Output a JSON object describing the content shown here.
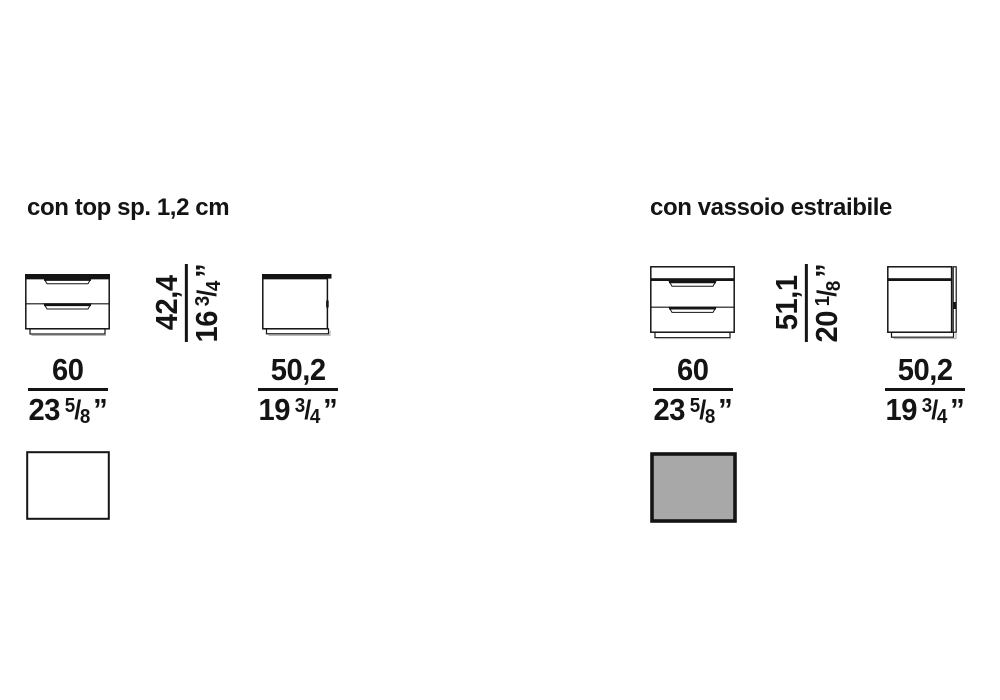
{
  "inch_mark": "”",
  "fraction_slash": "/",
  "sections": [
    {
      "title": "con top sp. 1,2 cm",
      "height": {
        "cm": "42,4",
        "in_whole": "16",
        "in_num": "3",
        "in_den": "4"
      },
      "width": {
        "cm": "60",
        "in_whole": "23",
        "in_num": "5",
        "in_den": "8"
      },
      "depth": {
        "cm": "50,2",
        "in_whole": "19",
        "in_num": "3",
        "in_den": "4"
      },
      "top_view_fill": "#ffffff"
    },
    {
      "title": "con vassoio estraibile",
      "height": {
        "cm": "51,1",
        "in_whole": "20",
        "in_num": "1",
        "in_den": "8"
      },
      "width": {
        "cm": "60",
        "in_whole": "23",
        "in_num": "5",
        "in_den": "8"
      },
      "depth": {
        "cm": "50,2",
        "in_whole": "19",
        "in_num": "3",
        "in_den": "4"
      },
      "top_view_fill": "#a8a8a8"
    }
  ],
  "colors": {
    "line": "#141414",
    "shadow": "#b8b8b8"
  }
}
